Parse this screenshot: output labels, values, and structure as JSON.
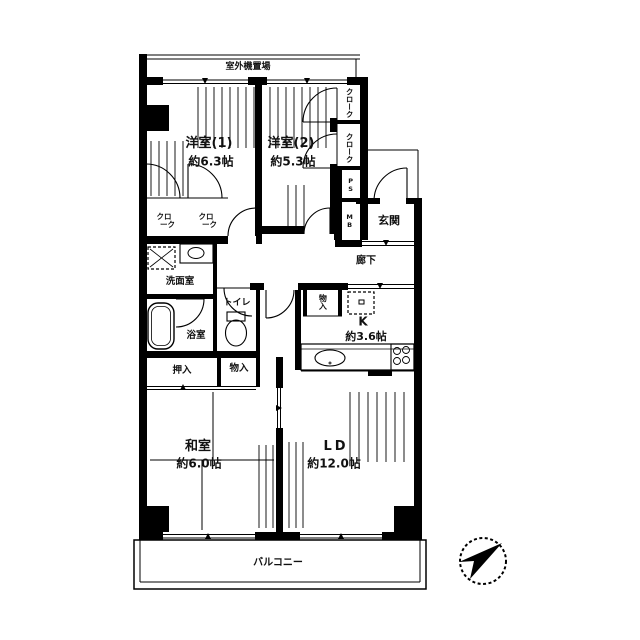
{
  "plan": {
    "outdoor_unit_label": "室外機置場",
    "balcony_label": "バルコニー",
    "compass": {
      "needle_direction": "NE"
    },
    "rooms": {
      "western1": {
        "name": "洋室(1)",
        "size": "約6.3帖"
      },
      "western2": {
        "name": "洋室(2)",
        "size": "約5.3帖"
      },
      "japanese": {
        "name": "和室",
        "size": "約6.0帖"
      },
      "living_dining": {
        "name": "LD",
        "size": "約12.0帖"
      },
      "kitchen": {
        "name": "K",
        "size": "約3.6帖"
      },
      "entrance": {
        "name": "玄関"
      },
      "hallway": {
        "name": "廊下"
      },
      "toilet": {
        "name": "トイレ"
      },
      "washroom": {
        "name": "洗面室"
      },
      "bathroom": {
        "name": "浴室"
      }
    },
    "storage": {
      "cloak": "クローク",
      "cloak_line1": "クロ",
      "cloak_line2": "ーク",
      "oshiire": "押入",
      "monoire": "物入",
      "ps": "PS",
      "mb": "MB"
    }
  }
}
